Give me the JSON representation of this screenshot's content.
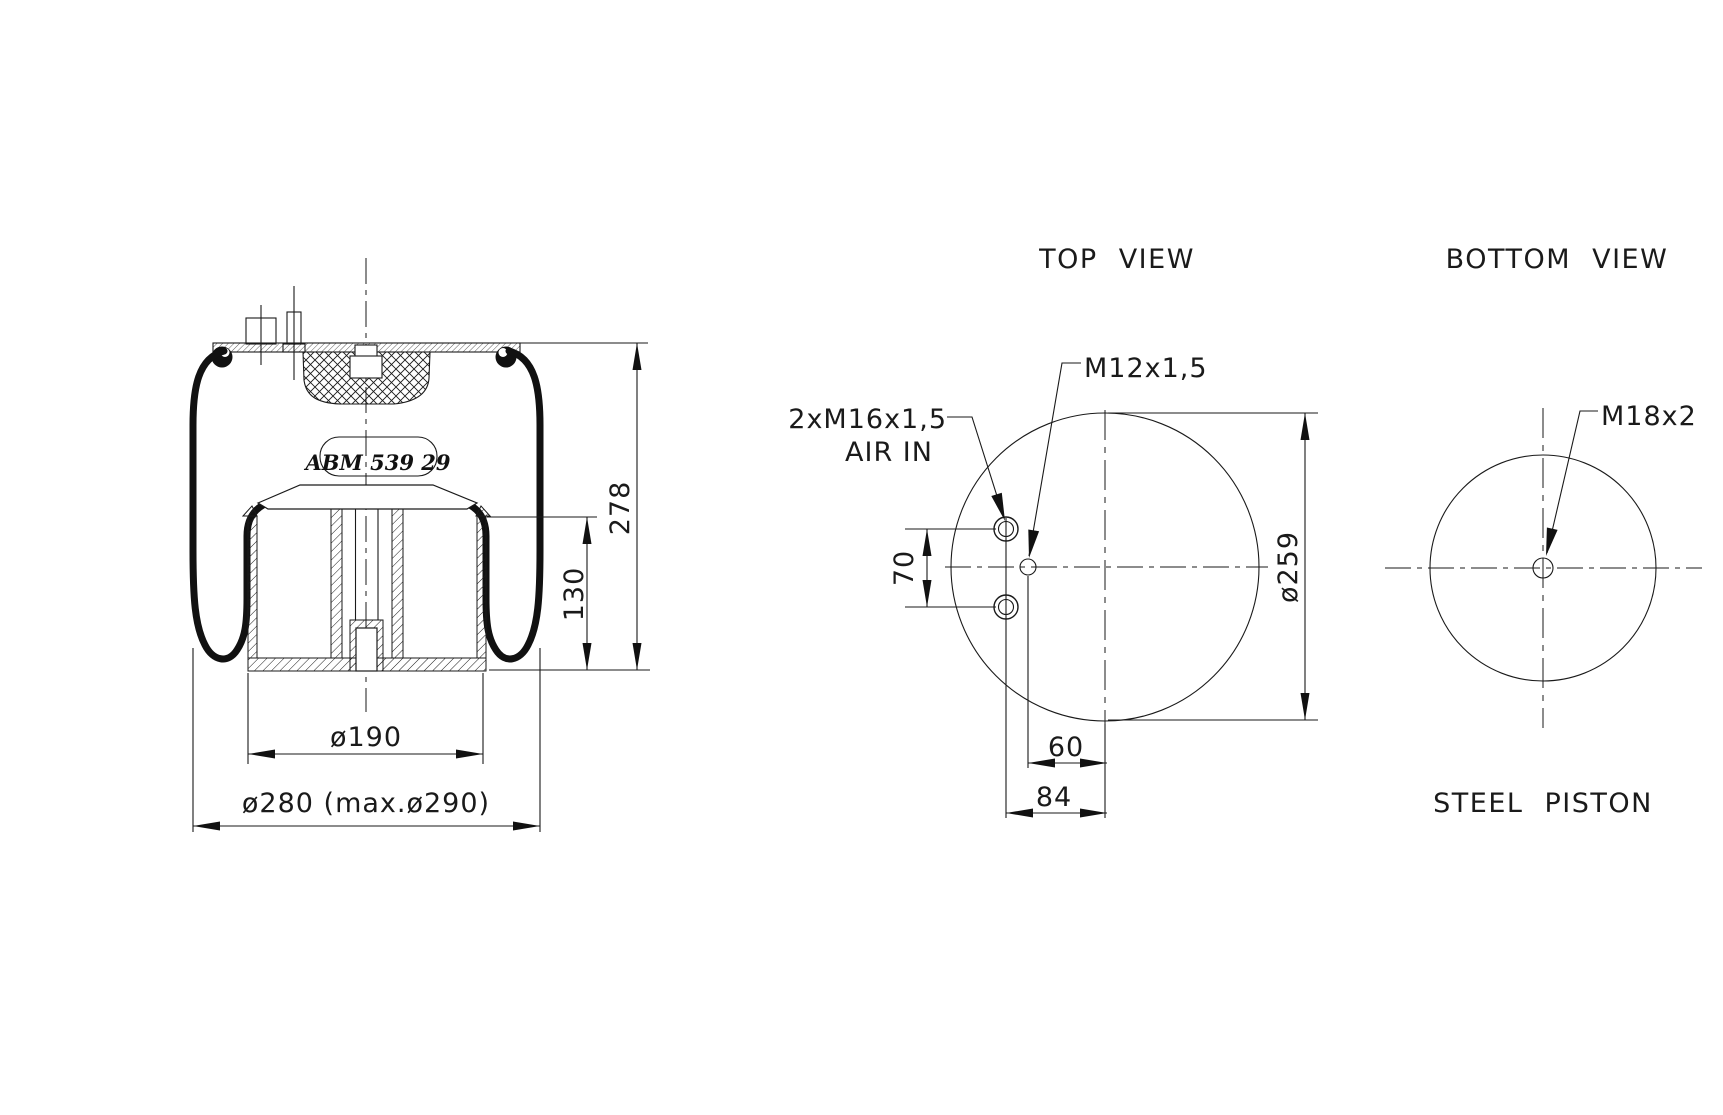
{
  "colors": {
    "line": "#1a1a1a",
    "background": "#ffffff"
  },
  "side_view": {
    "part_label": "ABM 539 29",
    "dim_piston_diameter": "ø190",
    "dim_max_diameter": "ø280 (max.ø290)",
    "dim_overall_height": "278",
    "dim_piston_height": "130"
  },
  "top_view": {
    "title": "TOP VIEW",
    "air_ports_label": "2xM16x1,5",
    "air_in_label": "AIR IN",
    "stud_label": "M12x1,5",
    "dim_plate_diameter": "ø259",
    "dim_port_spacing": "70",
    "dim_stud_offset": "60",
    "dim_port_offset": "84"
  },
  "bottom_view": {
    "title": "BOTTOM VIEW",
    "thread_label": "M18x2",
    "caption": "STEEL PISTON"
  }
}
